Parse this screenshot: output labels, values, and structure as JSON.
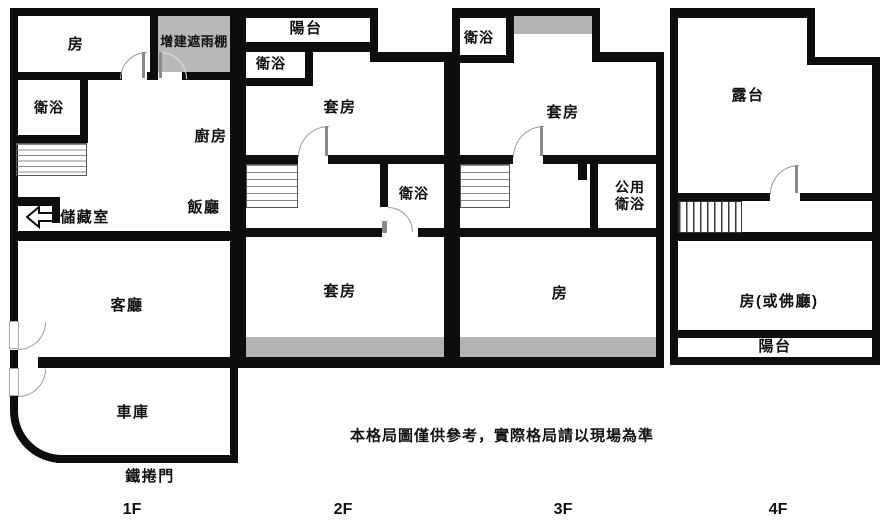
{
  "disclaimer": "本格局圖僅供參考，實際格局請以現場為準",
  "colors": {
    "wall": "#0d0d0d",
    "shade": "#b3b3b3",
    "canopy_fill": "#b8b8b8",
    "text": "#111111",
    "background": "#ffffff"
  },
  "floors": [
    {
      "label": "1F",
      "rooms": {
        "bedroom": "房",
        "rain_canopy": "增建遮雨棚",
        "bathroom": "衛浴",
        "kitchen": "廚房",
        "storage": "儲藏室",
        "dining": "飯廳",
        "living_room": "客廳",
        "garage": "車庫"
      },
      "annotations": {
        "rolling_door": "鐵捲門"
      }
    },
    {
      "label": "2F",
      "rooms": {
        "balcony": "陽台",
        "bathroom_upper": "衛浴",
        "suite_upper": "套房",
        "bathroom_mid": "衛浴",
        "suite_lower": "套房"
      }
    },
    {
      "label": "3F",
      "rooms": {
        "bathroom_upper": "衛浴",
        "suite": "套房",
        "shared_bathroom": "公用衛浴",
        "shared_bathroom_line1": "公用",
        "shared_bathroom_line2": "衛浴",
        "room": "房"
      }
    },
    {
      "label": "4F",
      "rooms": {
        "terrace": "露台",
        "room": "房(或佛廳)",
        "balcony": "陽台"
      }
    }
  ]
}
